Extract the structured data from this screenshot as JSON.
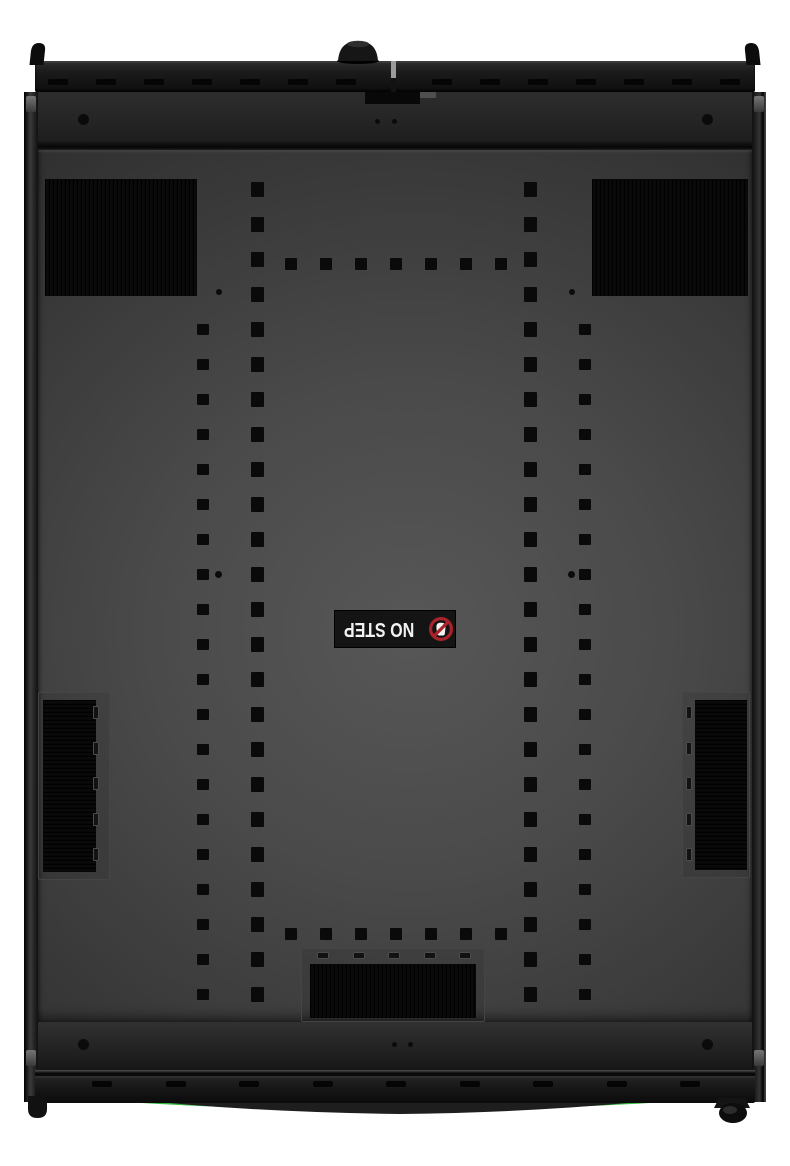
{
  "scene": {
    "type": "product-photo",
    "subject": "black server rack enclosure, top-down view of roof panel",
    "background_color": "#ffffff"
  },
  "label": {
    "text": "NO STEP",
    "rotation_deg": 180,
    "icon": "no-step-icon",
    "background": "#141414",
    "text_color": "#f2f2f2"
  },
  "colors": {
    "accent_green": "#35b53c",
    "prohibition_red": "#a8232a",
    "panel_center": "#545454",
    "panel_edge": "#2f2f2f",
    "hardware_black": "#101010",
    "white_background": "#ffffff"
  },
  "perforations": {
    "groups": [
      {
        "name": "top-bar-slot",
        "css": "slot",
        "x": 48,
        "y": 79,
        "count": 7,
        "dx": 48,
        "dy": 0,
        "w": 20,
        "h": 6
      },
      {
        "name": "top-bar-slot",
        "css": "slot",
        "x": 432,
        "y": 79,
        "count": 7,
        "dx": 48,
        "dy": 0,
        "w": 20,
        "h": 6
      },
      {
        "name": "roof-hole-column-outer-left",
        "css": "hole",
        "x": 197,
        "y": 324,
        "count": 20,
        "dx": 0,
        "dy": 35,
        "w": 12,
        "h": 11
      },
      {
        "name": "roof-hole-column-inner-left",
        "css": "hole",
        "x": 251,
        "y": 182,
        "count": 24,
        "dx": 0,
        "dy": 35,
        "w": 13,
        "h": 15
      },
      {
        "name": "roof-hole-column-inner-right",
        "css": "hole",
        "x": 524,
        "y": 182,
        "count": 24,
        "dx": 0,
        "dy": 35,
        "w": 13,
        "h": 15
      },
      {
        "name": "roof-hole-column-outer-right",
        "css": "hole",
        "x": 579,
        "y": 324,
        "count": 20,
        "dx": 0,
        "dy": 35,
        "w": 12,
        "h": 11
      },
      {
        "name": "roof-hole-row-top",
        "css": "hole",
        "x": 285,
        "y": 258,
        "count": 7,
        "dx": 35,
        "dy": 0,
        "w": 12,
        "h": 12
      },
      {
        "name": "roof-hole-row-bottom",
        "css": "hole",
        "x": 285,
        "y": 928,
        "count": 7,
        "dx": 35,
        "dy": 0,
        "w": 12,
        "h": 12
      },
      {
        "name": "roof-pilot-hole",
        "css": "round-hole",
        "x": 216,
        "y": 289,
        "count": 1,
        "dx": 0,
        "dy": 0,
        "w": 6,
        "h": 6,
        "round": true
      },
      {
        "name": "roof-pilot-hole",
        "css": "round-hole",
        "x": 569,
        "y": 289,
        "count": 1,
        "dx": 0,
        "dy": 0,
        "w": 6,
        "h": 6,
        "round": true
      },
      {
        "name": "roof-pilot-hole",
        "css": "round-hole",
        "x": 215,
        "y": 571,
        "count": 1,
        "dx": 0,
        "dy": 0,
        "w": 7,
        "h": 7,
        "round": true
      },
      {
        "name": "roof-pilot-hole",
        "css": "round-hole",
        "x": 568,
        "y": 571,
        "count": 1,
        "dx": 0,
        "dy": 0,
        "w": 7,
        "h": 7,
        "round": true
      },
      {
        "name": "upper-flange-hole",
        "css": "round-hole",
        "x": 78,
        "y": 114,
        "count": 1,
        "dx": 0,
        "dy": 0,
        "w": 11,
        "h": 11,
        "round": true
      },
      {
        "name": "upper-flange-hole",
        "css": "round-hole",
        "x": 702,
        "y": 114,
        "count": 1,
        "dx": 0,
        "dy": 0,
        "w": 11,
        "h": 11,
        "round": true
      },
      {
        "name": "upper-flange-dot",
        "css": "round-hole",
        "x": 375,
        "y": 119,
        "count": 2,
        "dx": 17,
        "dy": 0,
        "w": 5,
        "h": 5,
        "round": true
      },
      {
        "name": "lower-flange-hole",
        "css": "round-hole",
        "x": 78,
        "y": 1039,
        "count": 1,
        "dx": 0,
        "dy": 0,
        "w": 11,
        "h": 11,
        "round": true
      },
      {
        "name": "lower-flange-hole",
        "css": "round-hole",
        "x": 702,
        "y": 1039,
        "count": 1,
        "dx": 0,
        "dy": 0,
        "w": 11,
        "h": 11,
        "round": true
      },
      {
        "name": "lower-flange-dot",
        "css": "round-hole",
        "x": 392,
        "y": 1042,
        "count": 2,
        "dx": 16,
        "dy": 0,
        "w": 5,
        "h": 5,
        "round": true
      },
      {
        "name": "bottom-bar-slot",
        "css": "slot",
        "x": 92,
        "y": 1081,
        "count": 9,
        "dx": 73.5,
        "dy": 0,
        "w": 20,
        "h": 6
      },
      {
        "name": "bottom-grommet-frame-slot",
        "css": "frame-slot",
        "x": 317,
        "y": 952,
        "count": 5,
        "dx": 35.5,
        "dy": 0,
        "w": 12,
        "h": 7
      },
      {
        "name": "side-grommet-frame-slot-left",
        "css": "frame-slot",
        "x": 93,
        "y": 706,
        "count": 5,
        "dx": 0,
        "dy": 35.5,
        "w": 6,
        "h": 13
      },
      {
        "name": "side-grommet-frame-slot-right",
        "css": "frame-slot",
        "x": 686,
        "y": 706,
        "count": 5,
        "dx": 0,
        "dy": 35.5,
        "w": 6,
        "h": 13
      }
    ]
  }
}
